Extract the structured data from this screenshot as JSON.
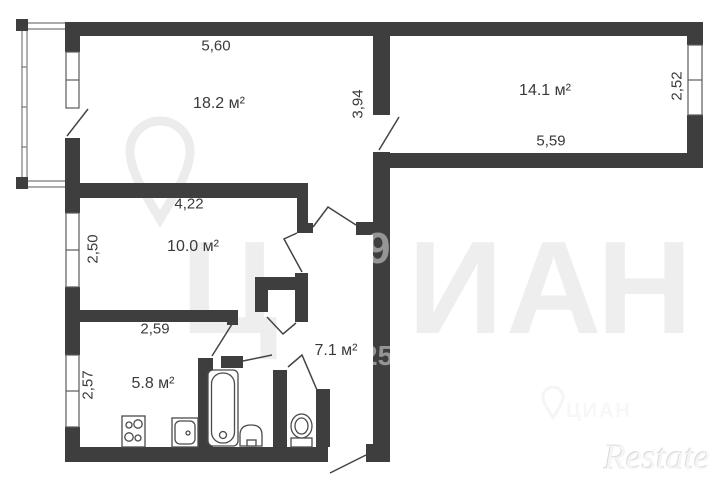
{
  "floorplan": {
    "areas": {
      "living": "18.2 м²",
      "bedroom": "14.1 м²",
      "room3": "10.0 м²",
      "kitchen": "5.8 м²",
      "hallway": "7.1 м²"
    },
    "dims": {
      "d560": "5,60",
      "d394": "3,94",
      "d559": "5,59",
      "d252": "2,52",
      "d422": "4,22",
      "d250": "2,50",
      "d259": "2,59",
      "d257": "2,57"
    },
    "watermark": {
      "brand_letters": [
        "Ц",
        "И",
        "А",
        "Н"
      ],
      "digit_top": "9",
      "digit_bottom": "25",
      "brand_small": "ЦИАН",
      "agency": "Restate"
    },
    "colors": {
      "wall": "#3e3e3e",
      "line": "#4a4a4a",
      "text": "#3a3a3a",
      "watermark_light": "#eeeeee"
    }
  }
}
